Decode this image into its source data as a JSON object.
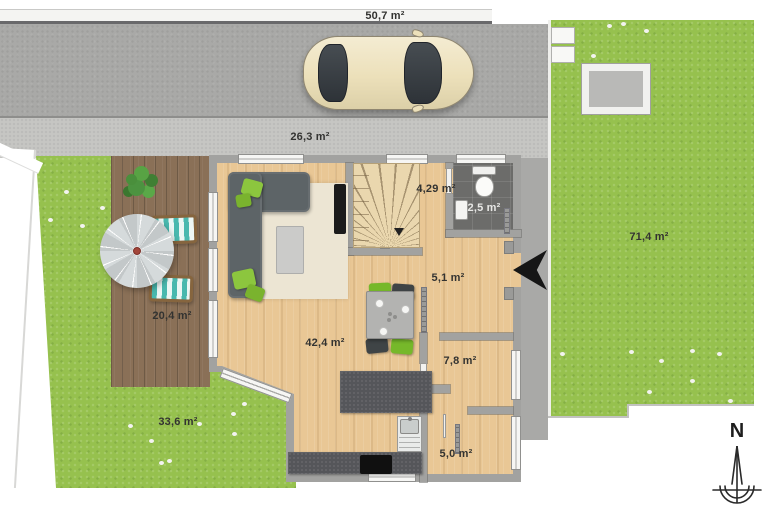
{
  "areas": {
    "driveway": "50,7 m²",
    "front_path": "26,3 m²",
    "garden_right": "71,4 m²",
    "terrace": "20,4 m²",
    "garden_left": "33,6 m²",
    "living": "42,4 m²",
    "staircase": "4,29 m²",
    "wc": "2,5 m²",
    "hall": "5,1 m²",
    "room_medium": "7,8 m²",
    "room_small": "5,0 m²"
  },
  "compass": {
    "north": "N"
  },
  "colors": {
    "lawn": "#96c14e",
    "deck": "#8a7057",
    "driveway": "#a9a9a7",
    "front_path": "#c6c6c3",
    "wall": "#a2a2a0",
    "wood_floor": "#e9c795",
    "kitchen_counter": "#55565a",
    "sofa": "#5d6467",
    "accent_green": "#8cc63e",
    "wc_floor": "#6c6c6a",
    "lounger_teal": "#49b8ae",
    "car_body": "#ece0ba"
  }
}
